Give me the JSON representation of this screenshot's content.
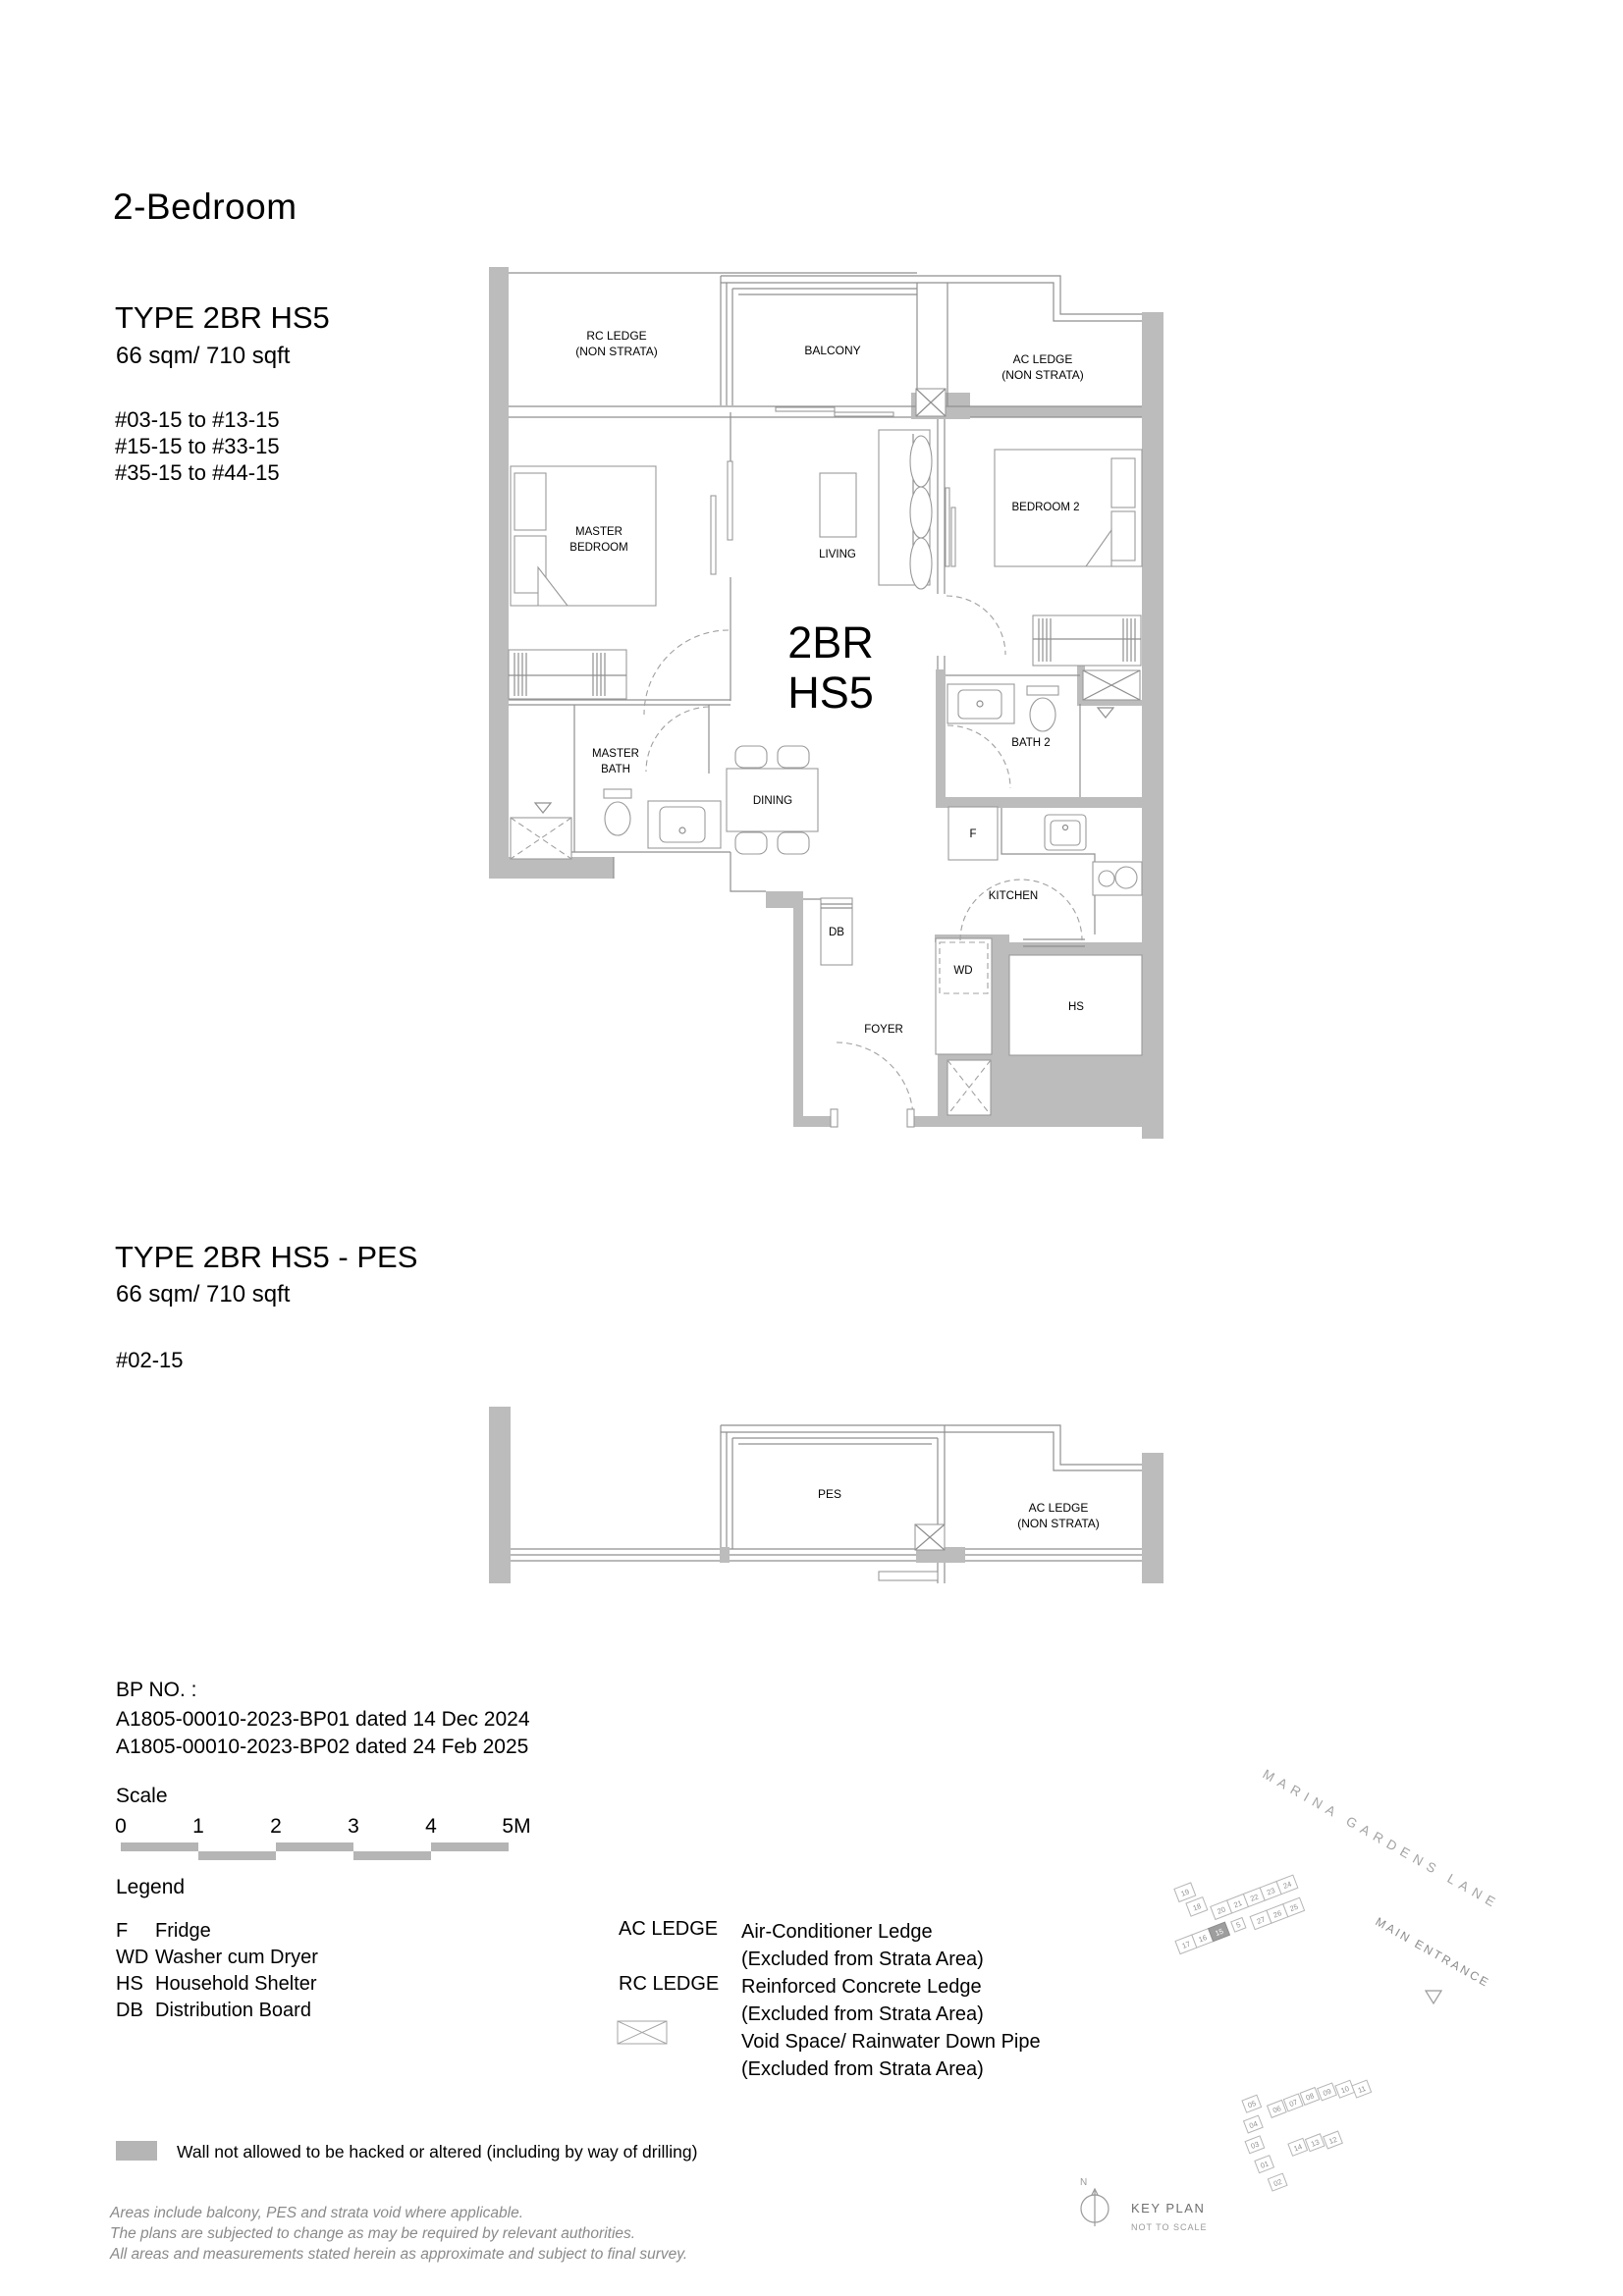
{
  "page": {
    "title": "2-Bedroom"
  },
  "unit_a": {
    "type_label": "TYPE 2BR HS5",
    "area": "66 sqm/ 710 sqft",
    "levels": [
      "#03-15 to #13-15",
      "#15-15 to #33-15",
      "#35-15 to #44-15"
    ]
  },
  "unit_b": {
    "type_label": "TYPE 2BR HS5 - PES",
    "area": "66 sqm/ 710 sqft",
    "levels": [
      "#02-15"
    ]
  },
  "plan": {
    "unit_code_line1": "2BR",
    "unit_code_line2": "HS5",
    "labels": {
      "rc_ledge_1": "RC LEDGE",
      "rc_ledge_2": "(NON STRATA)",
      "balcony": "BALCONY",
      "ac_ledge_1": "AC LEDGE",
      "ac_ledge_2": "(NON STRATA)",
      "master_bedroom_1": "MASTER",
      "master_bedroom_2": "BEDROOM",
      "living": "LIVING",
      "bedroom2": "BEDROOM 2",
      "master_bath_1": "MASTER",
      "master_bath_2": "BATH",
      "dining": "DINING",
      "bath2": "BATH 2",
      "fridge": "F",
      "kitchen": "KITCHEN",
      "db": "DB",
      "wd": "WD",
      "hs": "HS",
      "foyer": "FOYER"
    },
    "pes_labels": {
      "pes": "PES",
      "ac_ledge_1": "AC LEDGE",
      "ac_ledge_2": "(NON STRATA)"
    }
  },
  "bp": {
    "heading": "BP NO. :",
    "lines": [
      "A1805-00010-2023-BP01 dated 14 Dec 2024",
      "A1805-00010-2023-BP02 dated 24 Feb 2025"
    ]
  },
  "scale": {
    "heading": "Scale",
    "ticks": [
      "0",
      "1",
      "2",
      "3",
      "4",
      "5M"
    ]
  },
  "legend": {
    "heading": "Legend",
    "abbreviations": [
      {
        "abbr": "F",
        "desc": "Fridge"
      },
      {
        "abbr": "WD",
        "desc": "Washer cum Dryer"
      },
      {
        "abbr": "HS",
        "desc": "Household Shelter"
      },
      {
        "abbr": "DB",
        "desc": "Distribution Board"
      }
    ],
    "ledges": [
      {
        "abbr": "AC LEDGE",
        "desc": "Air-Conditioner Ledge",
        "note": "(Excluded from Strata Area)"
      },
      {
        "abbr": "RC LEDGE",
        "desc": "Reinforced Concrete Ledge",
        "note": "(Excluded from Strata Area)"
      },
      {
        "abbr": "",
        "desc": "Void Space/ Rainwater Down Pipe",
        "note": "(Excluded from Strata Area)"
      }
    ],
    "wall_note": "Wall not allowed to be hacked or altered (including by way of drilling)"
  },
  "disclaimer": [
    "Areas include balcony, PES and strata void where applicable.",
    "The plans are subjected to change as may be required by relevant authorities.",
    "All areas and measurements stated herein as approximate and subject to final survey."
  ],
  "keyplan": {
    "road": "MARINA GARDENS LANE",
    "entrance": "MAIN ENTRANCE",
    "north": "N",
    "title": "KEY PLAN",
    "subtitle": "NOT TO SCALE",
    "highlighted_unit": "15",
    "upper_units": [
      "19",
      "18",
      "20",
      "21",
      "22",
      "23",
      "24",
      "17",
      "16",
      "15",
      "5",
      "27",
      "26",
      "25"
    ],
    "lower_units": [
      "05",
      "04",
      "03",
      "06",
      "07",
      "08",
      "09",
      "10",
      "11",
      "01",
      "14",
      "13",
      "12",
      "02"
    ]
  },
  "colors": {
    "wall_gray": "#bcbcbc",
    "line_gray": "#8f8f8f",
    "scale_bar_gray": "#b5b5b5",
    "disclaimer_gray": "#8a8a8a",
    "keyplan_gray": "#9a9a9a",
    "highlight_fill": "#9e9e9e"
  }
}
